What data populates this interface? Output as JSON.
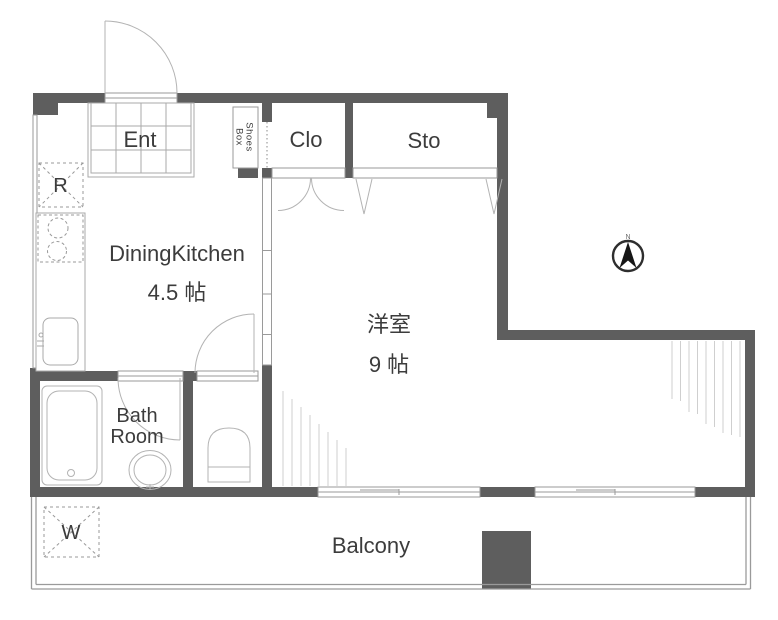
{
  "colors": {
    "wall": "#5e5e5e",
    "thin": "#9a9a9a",
    "fixture": "#b3b3b3",
    "hatch": "#cfcfcf",
    "text": "#3c3c3c"
  },
  "labels": {
    "entrance": "Ent",
    "shoes_box_line1": "Shoes",
    "shoes_box_line2": "Box",
    "closet": "Clo",
    "storage": "Sto",
    "dining_kitchen_name": "DiningKitchen",
    "dining_kitchen_size": "4.5 帖",
    "western_room_name": "洋室",
    "western_room_size": "9 帖",
    "bath_line1": "Bath",
    "bath_line2": "Room",
    "balcony": "Balcony",
    "refrigerator": "R",
    "washer": "W",
    "compass_north": "N"
  }
}
